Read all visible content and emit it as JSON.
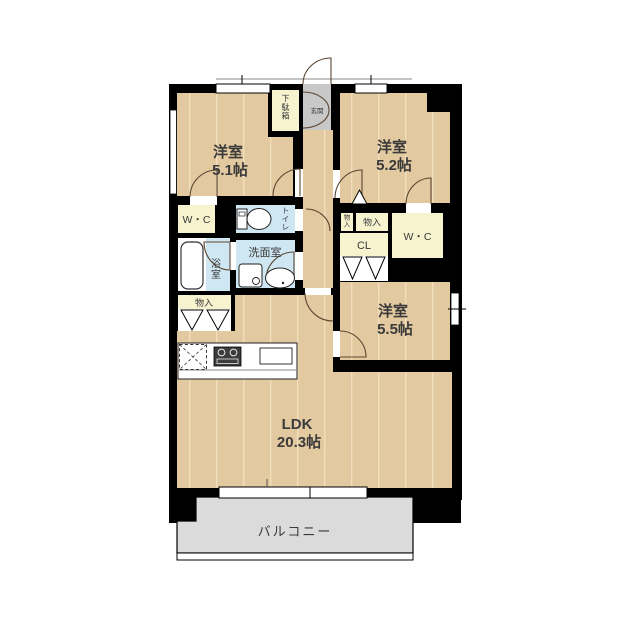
{
  "title": "apartment-floor-plan",
  "rooms": {
    "western1": {
      "label": "洋室",
      "size": "5.1帖"
    },
    "western2": {
      "label": "洋室",
      "size": "5.2帖"
    },
    "western3": {
      "label": "洋室",
      "size": "5.5帖"
    },
    "ldk": {
      "label": "LDK",
      "size": "20.3帖"
    },
    "balcony": {
      "label": "バルコニー"
    },
    "entrance": {
      "label": "玄関"
    },
    "shoe_cabinet": {
      "label": "下駄箱"
    },
    "toilet": {
      "label": "トイレ"
    },
    "washroom": {
      "label": "洗面室"
    },
    "bathroom": {
      "label": "浴室"
    },
    "wc_left": {
      "label": "W・C"
    },
    "wc_right": {
      "label": "W・C"
    },
    "storage_left": {
      "label": "物入"
    },
    "storage_mini": {
      "label": "物入"
    },
    "storage_right": {
      "label": "物入"
    },
    "closet_cl": {
      "label": "CL"
    }
  },
  "colors": {
    "wall": "#000000",
    "floor": "#e3c99f",
    "plank_line": "#f0debc",
    "closet": "#f7f3cf",
    "wet_area": "#cfe7f3",
    "entrance_gray": "#c8c8c8",
    "balcony_gray": "#dbdbdb",
    "white": "#ffffff",
    "text": "#3a3a3a"
  }
}
